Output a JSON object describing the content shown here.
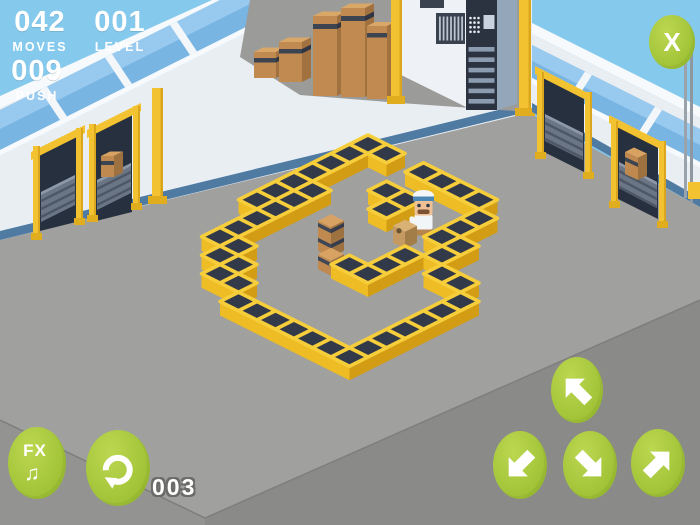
{
  "hud": {
    "moves": {
      "value": "042",
      "label": "MOVES"
    },
    "level": {
      "value": "001",
      "label": "LEVEL"
    },
    "push": {
      "value": "009",
      "label": "PUSH"
    },
    "undo_count": "003"
  },
  "buttons": {
    "close": {
      "label": "X"
    },
    "fx": {
      "label": "FX",
      "icon": "music-note",
      "glyph": "♫"
    },
    "undo": {
      "icon": "undo-circular-arrow"
    },
    "arrows": [
      {
        "id": "move-up-left",
        "direction": "up-left"
      },
      {
        "id": "move-down-left",
        "direction": "down-left"
      },
      {
        "id": "move-down-right",
        "direction": "down-right"
      },
      {
        "id": "move-up-right",
        "direction": "up-right"
      }
    ],
    "button_color": "#a6c73c"
  },
  "level_map": {
    "tile_w": 37,
    "tile_h": 18.5,
    "origin": {
      "x": 275.5,
      "y": 112
    },
    "walls": [
      [
        5,
        0
      ],
      [
        6,
        0
      ],
      [
        8,
        0
      ],
      [
        9,
        0
      ],
      [
        10,
        0
      ],
      [
        11,
        0
      ],
      [
        5,
        1
      ],
      [
        12,
        1
      ],
      [
        5,
        2
      ],
      [
        8,
        2
      ],
      [
        9,
        2
      ],
      [
        12,
        2
      ],
      [
        5,
        3
      ],
      [
        9,
        3
      ],
      [
        12,
        3
      ],
      [
        13,
        3
      ],
      [
        5,
        4
      ],
      [
        6,
        4
      ],
      [
        13,
        4
      ],
      [
        5,
        5
      ],
      [
        6,
        5
      ],
      [
        12,
        5
      ],
      [
        14,
        5
      ],
      [
        15,
        5
      ],
      [
        5,
        6
      ],
      [
        6,
        6
      ],
      [
        12,
        6
      ],
      [
        16,
        6
      ],
      [
        6,
        7
      ],
      [
        11,
        7
      ],
      [
        12,
        7
      ],
      [
        16,
        7
      ],
      [
        6,
        8
      ],
      [
        16,
        8
      ],
      [
        6,
        9
      ],
      [
        7,
        9
      ],
      [
        16,
        9
      ],
      [
        7,
        10
      ],
      [
        8,
        10
      ],
      [
        16,
        10
      ],
      [
        8,
        11
      ],
      [
        9,
        11
      ],
      [
        16,
        11
      ],
      [
        10,
        12
      ],
      [
        11,
        12
      ],
      [
        12,
        12
      ],
      [
        13,
        12
      ],
      [
        14,
        12
      ],
      [
        15,
        12
      ],
      [
        16,
        12
      ]
    ],
    "box_stack": {
      "cell": [
        9,
        6
      ],
      "count": 2
    },
    "boxes": [
      [
        10,
        7
      ]
    ],
    "player": {
      "cell": [
        11,
        3
      ],
      "facing": "down-left",
      "character": "warehouse-worker"
    },
    "hand_truck": {
      "cell": [
        11,
        4
      ],
      "load": "sack"
    }
  },
  "scene": {
    "left_wall": {
      "dock_doors": 2,
      "door_boxes": 1,
      "pillars": 1
    },
    "right_wall": {
      "dock_doors": 2,
      "door_boxes": 1,
      "pipes": 2
    },
    "mezzanine": {
      "cardboard_boxes": 5
    },
    "back_corner": {
      "control_rack": 1,
      "vent_grille": 1,
      "pillars": 2
    }
  },
  "palette": {
    "sky": "#85c9ec",
    "floor": "#a0a09e",
    "floor_edge_left": "#939391",
    "floor_edge_right": "#8a8a88",
    "wall": "#e9eef3",
    "wall_rim": "#f7fafc",
    "window_blue": "#79b5e3",
    "baseboard_blue": "#4f7ba3",
    "crate_side": "#eebc24",
    "crate_side_dark": "#d29c15",
    "crate_top": "#323a49",
    "crate_rim": "#f6cd3a",
    "cardboard": "#bf8950",
    "door_interior": "#27303f",
    "conveyor": "#6a7585",
    "pillar_yellow": "#f2c230",
    "button_green": "#a6c73c",
    "text_white": "#ffffff"
  }
}
